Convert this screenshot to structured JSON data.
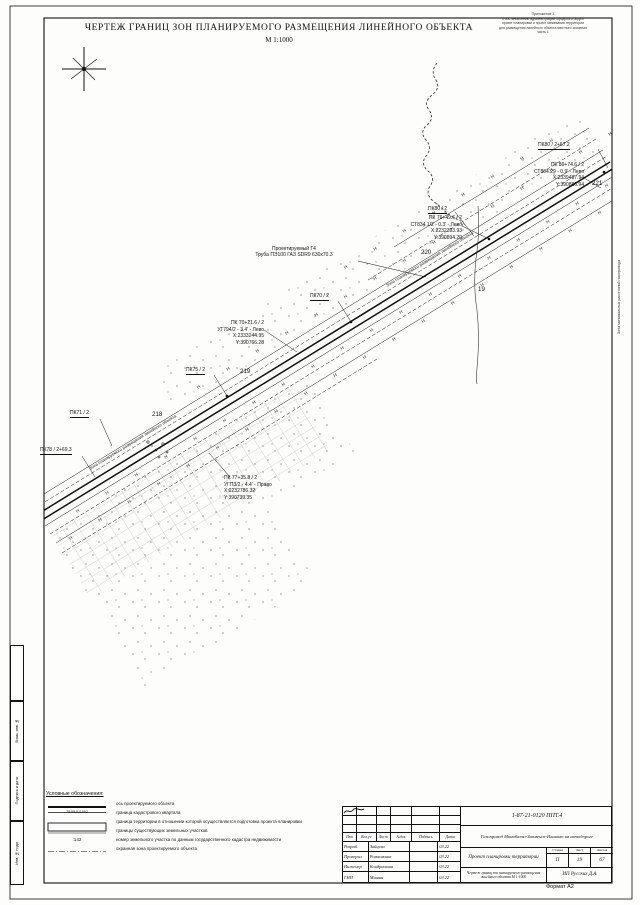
{
  "sheet": {
    "title": "ЧЕРТЕЖ ГРАНИЦ ЗОН ПЛАНИРУЕМОГО РАЗМЕЩЕНИЯ ЛИНЕЙНОГО ОБЪЕКТА",
    "scale": "М 1:1000",
    "corner_note": {
      "l1": "Приложение 1",
      "l2": "к постановлению администрации городского округа",
      "l3": "проект планировки и проект межевания территории",
      "l4": "для размещения линейного объекта местного значения",
      "l5": "часть 1"
    },
    "format_label": "Формат А2",
    "side_labels": {
      "vzam": "Взам. инв. №",
      "podp": "Подпись и дата",
      "inv": "Инв. № подл.",
      "right_edge": "Зона минимальных расстояний газопровода"
    }
  },
  "map": {
    "pipe1": "Проектируемый Г4",
    "pipe2": "Труба ПЭ100 ГАЗ SDR9 630х70.3",
    "zone_caption": "Зона планируемого размещения линейного объекта",
    "hatch": "Н Н Н Н Н Н Н Н Н Н Н Н Н Н Н Н Н Н Н Н Н Н",
    "hatch_short": "Н Н Н Н Н Н Н Н",
    "pk80_67": "ПК80 / 2+67.2",
    "pk80": "ПК80 / 2",
    "pk70": "ПК70 / 2",
    "pk75": "ПК75 / 2",
    "pk71": "ПК71 / 2",
    "pk78": "ПК78 / 2+69.3",
    "n221": "221",
    "n220": "220",
    "n219": "219",
    "n218": "218",
    "n19": "19",
    "block1": {
      "l1": "ПК 89+74.6 / 2",
      "l2": "СТ884.29 - 0.9' - Лево",
      "l3": "X:2339487.94",
      "l4": "Y:390886.94"
    },
    "block2": {
      "l1": "ПК 76+49.6 / 2",
      "l2": "СТ834.1/2 - 0.3' - Лево",
      "l3": "X:2232393.93",
      "l4": "Y:390894.20"
    },
    "block3": {
      "l1": "ПК 70+21.6 / 2",
      "l2": "УГ794/2 - 3.4' - Лево",
      "l3": "X:2333244.95",
      "l4": "Y:390766.28"
    },
    "block4": {
      "l1": "ПК 77+35.8 / 2",
      "l2": "УГП3/2 - 4.4' - Право",
      "l3": "X:2232786.32",
      "l4": "Y:390739.35"
    }
  },
  "legend": {
    "title": "Условные обозначения:",
    "items": [
      {
        "label": "ось проектируемого объекта"
      },
      {
        "sym": "70:05:011002",
        "label": "граница кадастрового квартала"
      },
      {
        "label": "граница территории в отношении которой осуществляется подготовка проекта планировки"
      },
      {
        "label": "границы существующих земельных участков"
      },
      {
        "sym": ":142",
        "label": "номер земельного участка по данным государственного кадастра недвижимости"
      },
      {
        "label": "охранная зона проектируемого объекта"
      }
    ]
  },
  "titleblock": {
    "doc_number": "1-87-21-0120 ППТ.4",
    "project": "Газопровод Минибаево-Знаменск-Иваново на автодороге",
    "doc_title": "Проект планировки территории",
    "drawing_title": "Чертеж границ зон планируемого размещения линейного объекта М 1:1000",
    "company": "ИП Русских Д.А.",
    "stage_h": "Стадия",
    "sheet_h": "Лист",
    "sheets_h": "Листов",
    "stage": "П",
    "sheet": "19",
    "sheets": "67",
    "cols": {
      "izm": "Изм",
      "koluch": "Кол.уч",
      "list": "Лист",
      "ndok": "№док",
      "podp": "Подпись",
      "data": "Дата"
    },
    "rows": [
      {
        "role": "Разраб.",
        "name": "Зайцева",
        "date": "03.22"
      },
      {
        "role": "Проверил",
        "name": "Ромашкина",
        "date": "03.22"
      },
      {
        "role": "Инженер",
        "name": "Кондрашова",
        "date": "03.22"
      },
      {
        "role": "ГИП",
        "name": "Мишин",
        "date": "03.22"
      }
    ]
  }
}
